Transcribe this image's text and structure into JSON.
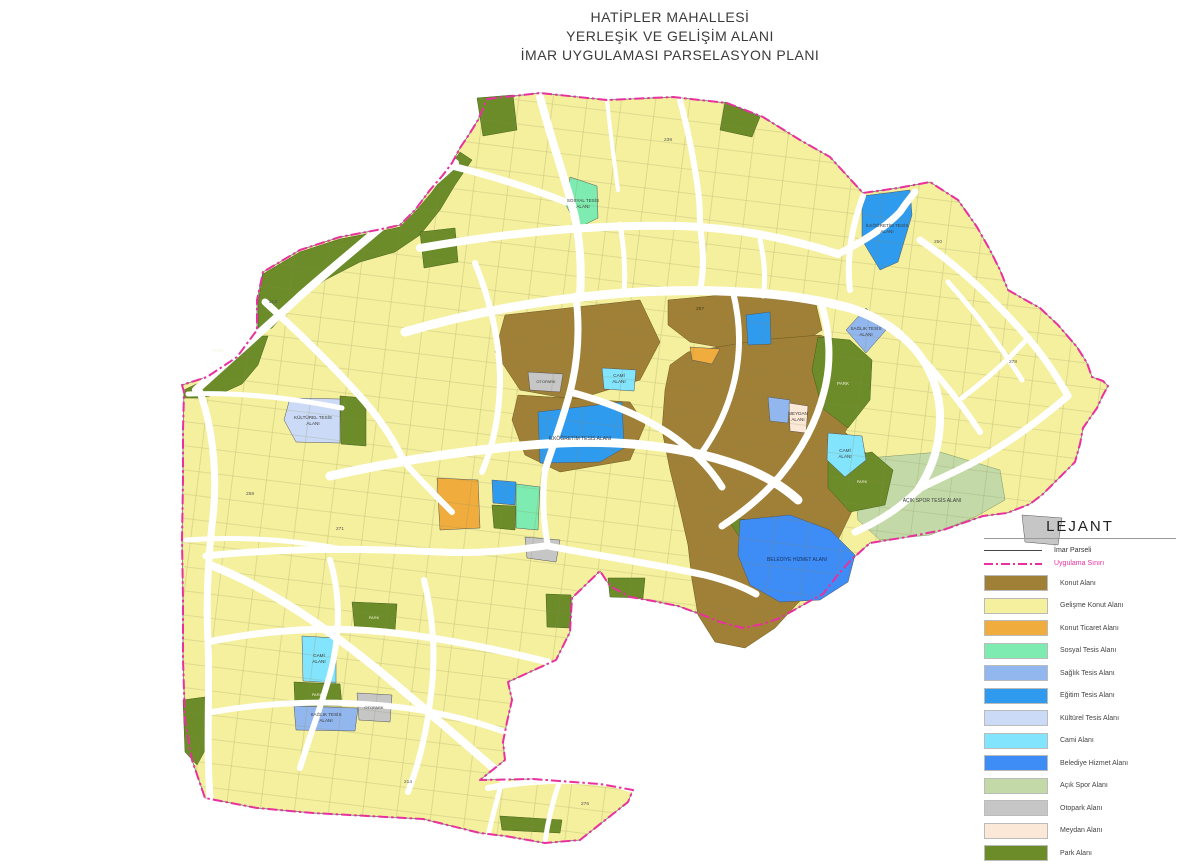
{
  "title": {
    "line1": "HATİPLER MAHALLESİ",
    "line2": "YERLEŞİK VE GELİŞİM ALANI",
    "line3": "İMAR UYGULAMASI PARSELASYON PLANI"
  },
  "palette": {
    "boundary": "#E8319E",
    "imar_line": "#444444",
    "road": "#FFFFFF",
    "parcel_line": "#8a8a55",
    "konut": "#A07F36",
    "gelisme": "#F5F09E",
    "ticaret": "#F0AD3D",
    "sosyal": "#7EECB0",
    "saglik": "#92B7EF",
    "egitim": "#2F9BEF",
    "kulturel": "#CBDBF7",
    "cami": "#82E4FD",
    "belediye": "#3E8CF6",
    "acik_spor": "#C3DAA8",
    "otopark": "#C6C6C6",
    "meydan": "#FBE8D7",
    "park": "#6B8C28"
  },
  "legend": {
    "title": "LEJANT",
    "line_items": [
      {
        "label": "İmar Parseli",
        "style": "solid"
      },
      {
        "label": "Uygulama Sınırı",
        "style": "dashdot"
      }
    ],
    "items": [
      {
        "key": "konut",
        "label": "Konut Alanı"
      },
      {
        "key": "gelisme",
        "label": "Gelişme Konut Alanı"
      },
      {
        "key": "ticaret",
        "label": "Konut Ticaret Alanı"
      },
      {
        "key": "sosyal",
        "label": "Sosyal Tesis Alanı"
      },
      {
        "key": "saglik",
        "label": "Sağlık Tesis Alanı"
      },
      {
        "key": "egitim",
        "label": "Eğitim Tesis Alanı"
      },
      {
        "key": "kulturel",
        "label": "Kültürel Tesis Alanı"
      },
      {
        "key": "cami",
        "label": "Cami Alanı"
      },
      {
        "key": "belediye",
        "label": "Belediye Hizmet Alanı"
      },
      {
        "key": "acik_spor",
        "label": "Açık Spor Alanı"
      },
      {
        "key": "otopark",
        "label": "Otopark Alanı"
      },
      {
        "key": "meydan",
        "label": "Meydan Alanı"
      },
      {
        "key": "park",
        "label": "Park Alanı"
      }
    ]
  },
  "map": {
    "labels": [
      {
        "t": "SOSYAL TESİS",
        "x": 583,
        "y": 202
      },
      {
        "t": "ALANI",
        "x": 583,
        "y": 208
      },
      {
        "t": "SAĞLIK TESİS",
        "x": 866,
        "y": 330
      },
      {
        "t": "ALANI",
        "x": 866,
        "y": 336
      },
      {
        "t": "İLKÖĞRETİM TESİS",
        "x": 887,
        "y": 227
      },
      {
        "t": "ALANI",
        "x": 887,
        "y": 233
      },
      {
        "t": "İLKÖĞRETİM TESİS ALANI",
        "x": 580,
        "y": 440,
        "s": 5
      },
      {
        "t": "BELEDİYE HİZMET ALANI",
        "x": 797,
        "y": 561,
        "s": 5,
        "c": "#17335c"
      },
      {
        "t": "AÇIK SPOR TESİS ALANI",
        "x": 932,
        "y": 502,
        "s": 5
      },
      {
        "t": "KÜLTÜREL TESİS",
        "x": 313,
        "y": 419
      },
      {
        "t": "ALANI",
        "x": 313,
        "y": 425
      },
      {
        "t": "CAMİ",
        "x": 619,
        "y": 377
      },
      {
        "t": "ALANI",
        "x": 619,
        "y": 383
      },
      {
        "t": "CAMİ",
        "x": 319,
        "y": 657
      },
      {
        "t": "ALANI",
        "x": 319,
        "y": 663
      },
      {
        "t": "CAMİ",
        "x": 845,
        "y": 452
      },
      {
        "t": "ALANI",
        "x": 845,
        "y": 458
      },
      {
        "t": "MEYDAN",
        "x": 798,
        "y": 415
      },
      {
        "t": "ALANI",
        "x": 798,
        "y": 421
      },
      {
        "t": "SAĞLIK TESİS",
        "x": 326,
        "y": 716
      },
      {
        "t": "ALANI",
        "x": 326,
        "y": 722
      },
      {
        "t": "OTOPARK",
        "x": 546,
        "y": 383,
        "s": 4
      },
      {
        "t": "OTOPARK",
        "x": 374,
        "y": 709,
        "s": 4
      },
      {
        "t": "PARK",
        "x": 218,
        "y": 352,
        "s": 4.5,
        "c": "#f2f2d8"
      },
      {
        "t": "PARK",
        "x": 843,
        "y": 385,
        "s": 4.5,
        "c": "#f2f2d8"
      },
      {
        "t": "PARK",
        "x": 374,
        "y": 619,
        "s": 4,
        "c": "#f2f2d8"
      },
      {
        "t": "PARK",
        "x": 862,
        "y": 483,
        "s": 4,
        "c": "#f2f2d8"
      },
      {
        "t": "PARK",
        "x": 317,
        "y": 696,
        "s": 4,
        "c": "#f2f2d8"
      },
      {
        "t": "213",
        "x": 273,
        "y": 303,
        "s": 4.8,
        "c": "#555"
      },
      {
        "t": "238",
        "x": 668,
        "y": 141,
        "s": 4.8,
        "c": "#555"
      },
      {
        "t": "278",
        "x": 1013,
        "y": 363,
        "s": 4.8,
        "c": "#555"
      },
      {
        "t": "276",
        "x": 585,
        "y": 805,
        "s": 4.8,
        "c": "#555"
      },
      {
        "t": "214",
        "x": 408,
        "y": 783,
        "s": 4.8,
        "c": "#555"
      },
      {
        "t": "258",
        "x": 250,
        "y": 495,
        "s": 4.8,
        "c": "#555"
      },
      {
        "t": "250",
        "x": 938,
        "y": 243,
        "s": 4.8,
        "c": "#555"
      },
      {
        "t": "271",
        "x": 340,
        "y": 530,
        "s": 4.8,
        "c": "#555"
      },
      {
        "t": "257",
        "x": 700,
        "y": 310,
        "s": 4.8,
        "c": "#4a3a1a"
      }
    ]
  }
}
